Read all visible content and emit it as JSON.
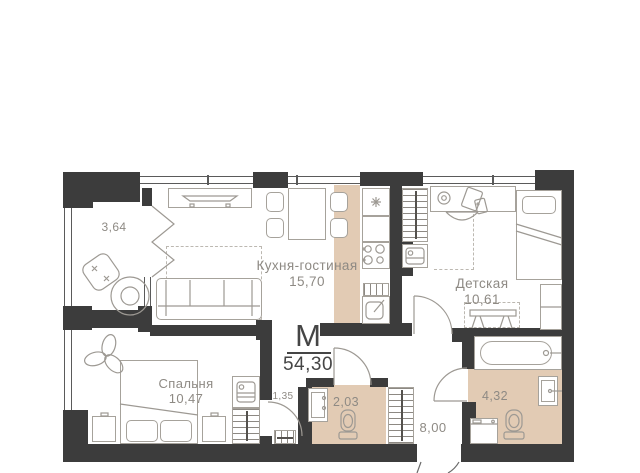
{
  "plan": {
    "badge": {
      "letter": "М",
      "total_area": "54,30"
    },
    "rooms": {
      "balcony": {
        "area": "3,64"
      },
      "kitchen_living": {
        "label": "Кухня-гостиная",
        "area": "15,70"
      },
      "children": {
        "label": "Детская",
        "area": "10,61"
      },
      "bedroom": {
        "label": "Спальня",
        "area": "10,47"
      },
      "corridor": {
        "area": "1,35"
      },
      "wc": {
        "area": "2,03"
      },
      "hallway": {
        "area": "8,00"
      },
      "bathroom": {
        "area": "4,32"
      }
    },
    "colors": {
      "wall": "#3c3c3c",
      "floor_accent": "#e2cbb4",
      "outline": "#a6a29b",
      "label_text": "#8e8a84",
      "badge_text": "#454545"
    }
  }
}
